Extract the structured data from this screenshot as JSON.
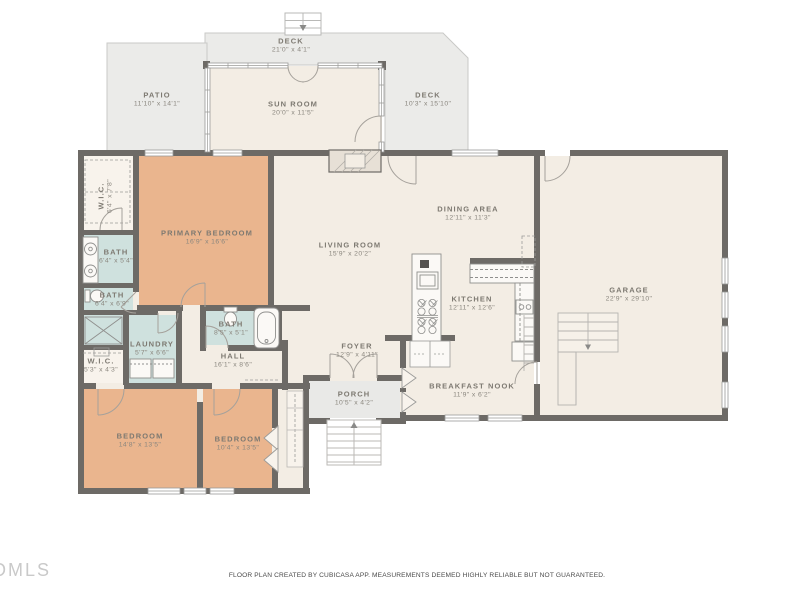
{
  "meta": {
    "watermark": "DMLS",
    "footer": "FLOOR PLAN CREATED BY CUBICASA APP. MEASUREMENTS DEEMED HIGHLY RELIABLE BUT NOT GUARANTEED."
  },
  "colors": {
    "wall": "#6d6a66",
    "room_cream": "#f3ede4",
    "bedroom_peach": "#eab58e",
    "bath_teal": "#cfe1de",
    "outdoor_gray": "#ebebe9",
    "label_text": "#7b776f"
  },
  "rooms": {
    "deck_top": {
      "name": "DECK",
      "dims": "21'0\" x 4'1\""
    },
    "patio": {
      "name": "PATIO",
      "dims": "11'10\" x 14'1\""
    },
    "sun_room": {
      "name": "SUN ROOM",
      "dims": "20'0\" x 11'5\""
    },
    "deck_right": {
      "name": "DECK",
      "dims": "10'3\" x 15'10\""
    },
    "wic_top": {
      "name": "W.I.C.",
      "dims": "6'4\" x 7'8\""
    },
    "primary_bedroom": {
      "name": "PRIMARY BEDROOM",
      "dims": "16'9\" x 16'6\""
    },
    "living_room": {
      "name": "LIVING ROOM",
      "dims": "15'9\" x 20'2\""
    },
    "dining_area": {
      "name": "DINING AREA",
      "dims": "12'11\" x 11'3\""
    },
    "garage": {
      "name": "GARAGE",
      "dims": "22'9\" x 29'10\""
    },
    "bath_1": {
      "name": "BATH",
      "dims": "6'4\" x 5'4\""
    },
    "bath_2": {
      "name": "BATH",
      "dims": "6'4\" x 6'9\""
    },
    "kitchen": {
      "name": "KITCHEN",
      "dims": "12'11\" x 12'6\""
    },
    "bath_3": {
      "name": "BATH",
      "dims": "8'5\" x 5'1\""
    },
    "laundry": {
      "name": "LAUNDRY",
      "dims": "5'7\" x 6'6\""
    },
    "wic_bottom": {
      "name": "W.I.C.",
      "dims": "5'3\" x 4'3\""
    },
    "hall": {
      "name": "HALL",
      "dims": "16'1\" x 8'6\""
    },
    "foyer": {
      "name": "FOYER",
      "dims": "12'9\" x 4'11\""
    },
    "breakfast_nook": {
      "name": "BREAKFAST NOOK",
      "dims": "11'9\" x 6'2\""
    },
    "porch": {
      "name": "PORCH",
      "dims": "10'5\" x 4'2\""
    },
    "bedroom_1": {
      "name": "BEDROOM",
      "dims": "14'8\" x 13'5\""
    },
    "bedroom_2": {
      "name": "BEDROOM",
      "dims": "10'4\" x 13'5\""
    }
  }
}
